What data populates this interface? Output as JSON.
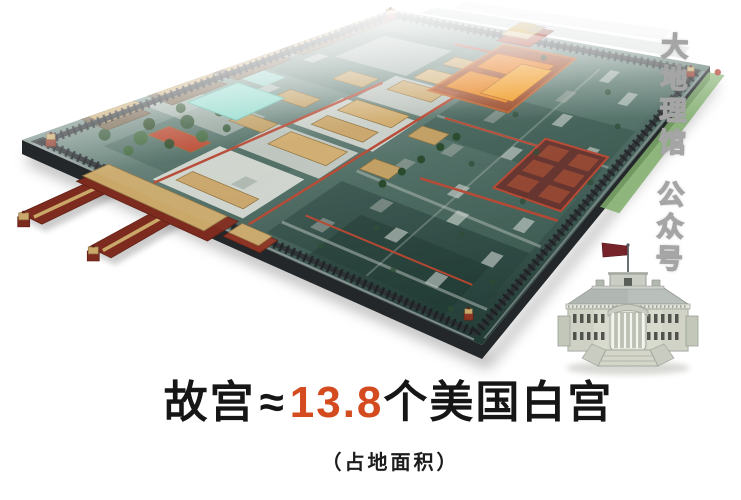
{
  "title": {
    "subject": "故宫",
    "approx": "≈",
    "ratio": "13.8",
    "comparison": "个美国白宫"
  },
  "subtitle": "（占地面积）",
  "watermark": {
    "line1": "大地理馆",
    "line2": "公众号"
  },
  "colors": {
    "accent_ratio": "#d44b1f",
    "title_text": "#161616",
    "watermark_fill": "#ffffff",
    "watermark_outline": "#a5a5a5",
    "map_ground_dark": "#223b35",
    "map_ground_mid": "#4d6b62",
    "map_ground_light": "#8aa099",
    "map_wall": "#2c3134",
    "roof_tan": "#c9a86a",
    "roof_orange": "#e8821c",
    "wall_red": "#b5452f",
    "gate_red": "#7d2b1e",
    "tree_green": "#2e5230",
    "pool_cyan": "#8fd9cb",
    "moat_green": "#7fae6b",
    "stone_white": "#d9dcd6",
    "house_body": "#d8dacd",
    "house_roof": "#b9bfba",
    "flag_red": "#76232a"
  }
}
